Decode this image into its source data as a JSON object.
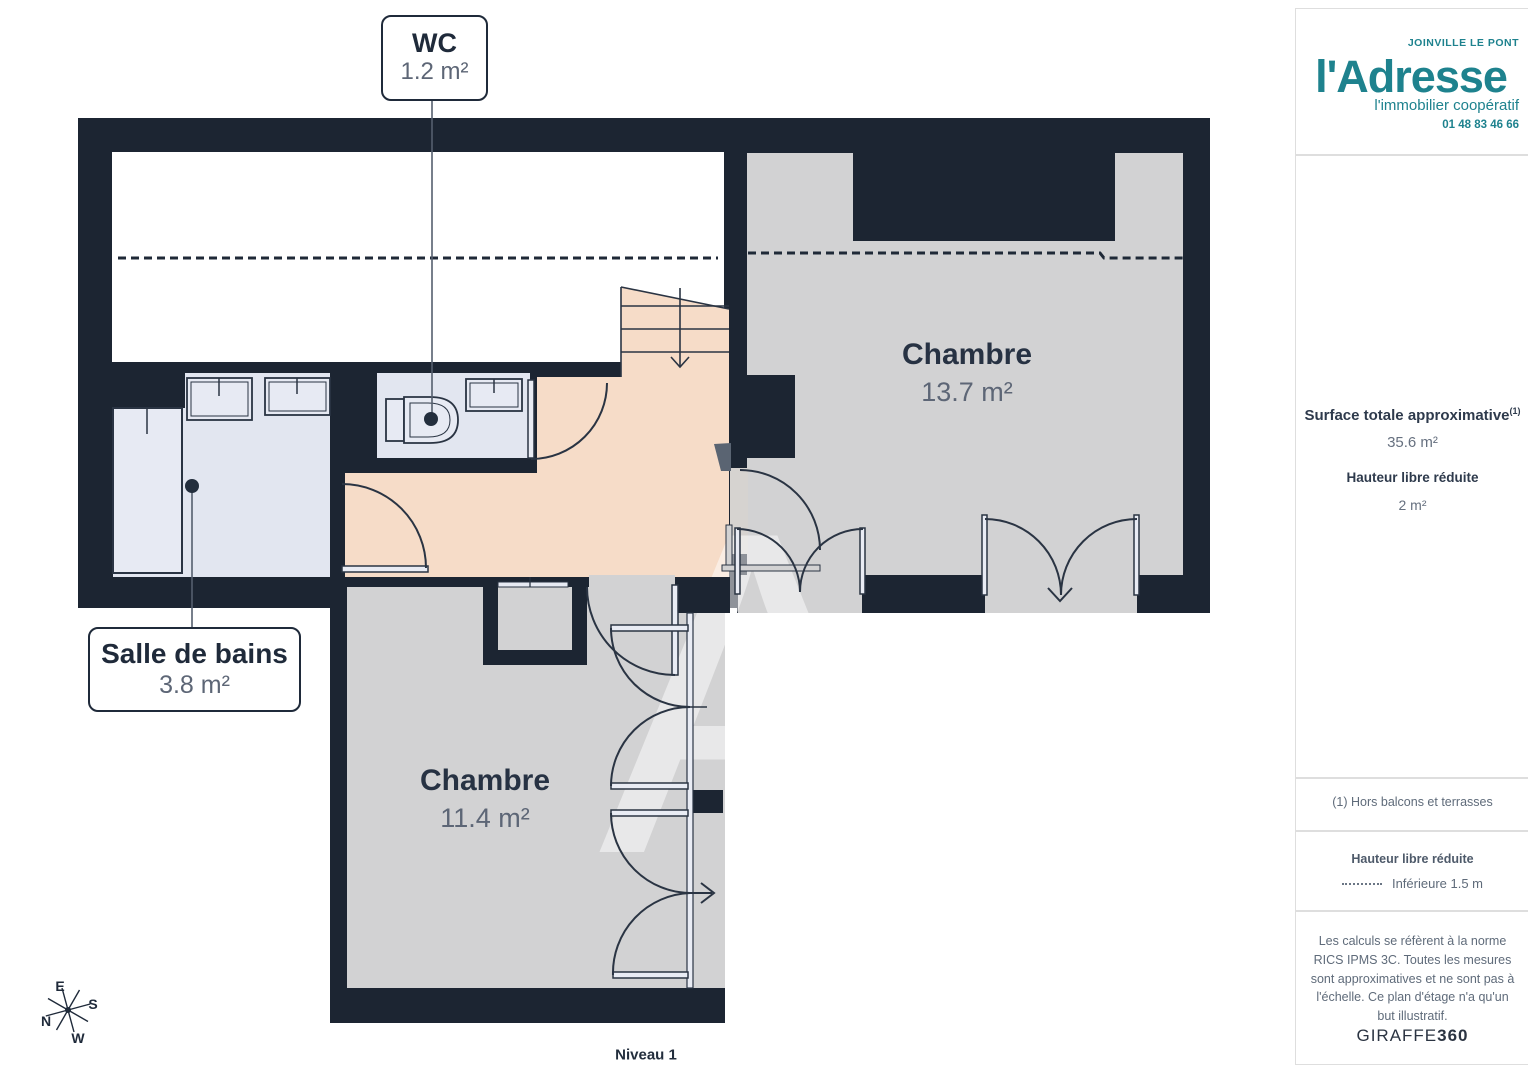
{
  "plan": {
    "wc": {
      "name": "WC",
      "area": "1.2 m²"
    },
    "bathroom": {
      "name": "Salle de bains",
      "area": "3.8 m²"
    },
    "bedroom_top": {
      "name": "Chambre",
      "area": "13.7 m²"
    },
    "bedroom_bottom": {
      "name": "Chambre",
      "area": "11.4 m²"
    },
    "level": "Niveau 1",
    "watermark": "A",
    "compass": {
      "e": "E",
      "s": "S",
      "n": "N",
      "w": "W"
    }
  },
  "sidebar": {
    "logo": {
      "brand": "l'Adresse",
      "city": "JOINVILLE LE PONT",
      "tagline": "l'immobilier coopératif",
      "phone": "01 48 83 46 66"
    },
    "surface_total": {
      "label": "Surface totale approximative",
      "sup": "(1)",
      "value": "35.6 m²"
    },
    "reduced_height": {
      "label": "Hauteur libre réduite",
      "value": "2 m²"
    },
    "footnote": "(1) Hors balcons et terrasses",
    "legend_reduced": {
      "title": "Hauteur libre réduite",
      "entry": "Inférieure 1.5 m"
    },
    "disclaimer": "Les calculs se réfèrent à la norme RICS IPMS 3C. Toutes les mesures sont approximatives et ne sont pas à l'échelle. Ce plan d'étage n'a qu'un but illustratif.",
    "vendor": {
      "name": "GIRAFFE",
      "suffix": "360"
    }
  },
  "colors": {
    "wall": "#1c2532",
    "floor_grey": "#d2d2d3",
    "floor_pink": "#f6dcc8",
    "floor_blue": "#e2e6f0",
    "accent_teal": "#1e828e"
  }
}
